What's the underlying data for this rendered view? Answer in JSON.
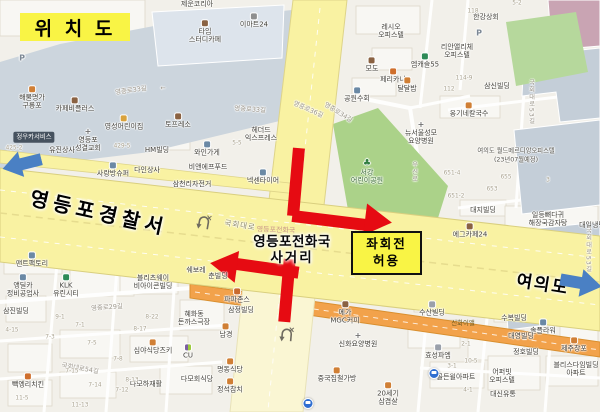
{
  "title": {
    "text": "위 치 도"
  },
  "annotations": {
    "police": "영등포경찰서",
    "yeouido": "여의도",
    "intersection_line1": "영등포전화국",
    "intersection_line2": "사거리",
    "intersection_watermark": "영등포전화국",
    "left_turn_line1": "좌회전",
    "left_turn_line2": "허용"
  },
  "colors": {
    "highlight_yellow": "#f9f445",
    "arrow_red": "#e60b12",
    "arrow_blue": "#4a80c4",
    "road_yellow": "#f9f2a2",
    "road_pale": "#faf6d3",
    "road_orange": "#f2a24b",
    "park_green": "#abd289",
    "site_blue_gray": "#ccd5dd"
  },
  "map_labels": [
    {
      "t": "제운코리아",
      "x": 197,
      "y": 4
    },
    {
      "t": "타임\n스터디카페",
      "x": 205,
      "y": 32,
      "icon": "cafe"
    },
    {
      "t": "이마트24",
      "x": 254,
      "y": 21,
      "icon": "store"
    },
    {
      "t": "해물명가\n구룡포",
      "x": 32,
      "y": 98,
      "icon": "food"
    },
    {
      "t": "카페비플러스",
      "x": 75,
      "y": 105,
      "icon": "cafe"
    },
    {
      "t": "영성어린이집",
      "x": 124,
      "y": 123,
      "icon": "school"
    },
    {
      "t": "영등포\n성결교회",
      "x": 88,
      "y": 140,
      "icon": "church"
    },
    {
      "t": "토프레소",
      "x": 178,
      "y": 121,
      "icon": "cafe"
    },
    {
      "t": "정우카서비스",
      "x": 34,
      "y": 137,
      "cls": "pill"
    },
    {
      "t": "P",
      "x": 22,
      "y": 58,
      "cls": "pmark"
    },
    {
      "t": "레시오\n오피스텔",
      "x": 391,
      "y": 31
    },
    {
      "t": "리안앨리체\n오피스텔",
      "x": 457,
      "y": 51
    },
    {
      "t": "한강상회",
      "x": 486,
      "y": 17
    },
    {
      "t": "P",
      "x": 479,
      "y": 33,
      "cls": "pmark"
    },
    {
      "t": "모도",
      "x": 372,
      "y": 65,
      "icon": "cafe"
    },
    {
      "t": "엠캐슬55",
      "x": 425,
      "y": 61,
      "icon": "bank"
    },
    {
      "t": "페리카나",
      "x": 393,
      "y": 76,
      "icon": "chicken"
    },
    {
      "t": "달달밥",
      "x": 407,
      "y": 85,
      "icon": "food"
    },
    {
      "t": "공원수회",
      "x": 357,
      "y": 95,
      "icon": "shop"
    },
    {
      "t": "옹기네칼국수",
      "x": 469,
      "y": 110,
      "icon": "food"
    },
    {
      "t": "삼신빌딩",
      "x": 497,
      "y": 86
    },
    {
      "t": "뉴서울성모\n요양병원",
      "x": 421,
      "y": 133,
      "icon": "hospital"
    },
    {
      "t": "여의도 월드메르디앙오피스텔",
      "x": 516,
      "y": 151,
      "cls": "small"
    },
    {
      "t": "(23년07월예정)",
      "x": 516,
      "y": 160,
      "cls": "small"
    },
    {
      "t": "서강\n어린이공원",
      "x": 367,
      "y": 172,
      "cls": "park-label",
      "icon": "park"
    },
    {
      "t": "유진상사",
      "x": 62,
      "y": 150
    },
    {
      "t": "HM빌딩",
      "x": 157,
      "y": 150
    },
    {
      "t": "와인가게",
      "x": 207,
      "y": 149,
      "icon": "shop"
    },
    {
      "t": "헤더드\n익스프레스",
      "x": 261,
      "y": 134
    },
    {
      "t": "비앤에프푸드",
      "x": 208,
      "y": 167
    },
    {
      "t": "사랑방슈퍼",
      "x": 113,
      "y": 170,
      "icon": "shop"
    },
    {
      "t": "다인상사",
      "x": 147,
      "y": 170
    },
    {
      "t": "삼천리자전거",
      "x": 192,
      "y": 184
    },
    {
      "t": "넥센타이어",
      "x": 263,
      "y": 177,
      "icon": "shop"
    },
    {
      "t": "대지빌딩",
      "x": 483,
      "y": 210
    },
    {
      "t": "일등뼈다귀\n해장국감자탕",
      "x": 548,
      "y": 219
    },
    {
      "t": "대일냉면",
      "x": 592,
      "y": 225
    },
    {
      "t": "에그카페24",
      "x": 470,
      "y": 231,
      "icon": "cafe"
    },
    {
      "t": "맨트팩토리",
      "x": 32,
      "y": 260,
      "icon": "shop"
    },
    {
      "t": "앵딜카\n정비공업사",
      "x": 23,
      "y": 286,
      "icon": "shop"
    },
    {
      "t": "삼진빌딩",
      "x": 16,
      "y": 311
    },
    {
      "t": "KLK\n유린시티",
      "x": 66,
      "y": 286,
      "icon": "bank"
    },
    {
      "t": "블리츠웨이\n비아이콘빌딩",
      "x": 153,
      "y": 282
    },
    {
      "t": "쉐보레",
      "x": 196,
      "y": 270
    },
    {
      "t": "춘빌딩",
      "x": 218,
      "y": 276
    },
    {
      "t": "혜화동\n돈까스극장",
      "x": 194,
      "y": 318
    },
    {
      "t": "심야식당츠키",
      "x": 153,
      "y": 347,
      "icon": "food"
    },
    {
      "t": "CU",
      "x": 188,
      "y": 352,
      "icon": "cu"
    },
    {
      "t": "다모하재활",
      "x": 146,
      "y": 384
    },
    {
      "t": "다모회식당",
      "x": 197,
      "y": 379
    },
    {
      "t": "빽엥리치킨",
      "x": 28,
      "y": 381,
      "icon": "chicken"
    },
    {
      "t": "명동식당",
      "x": 230,
      "y": 366,
      "icon": "food"
    },
    {
      "t": "정석참치",
      "x": 230,
      "y": 386,
      "icon": "food"
    },
    {
      "t": "남경",
      "x": 226,
      "y": 331,
      "icon": "food"
    },
    {
      "t": "파파존스",
      "x": 237,
      "y": 296,
      "icon": "pizza"
    },
    {
      "t": "삼정빌딩",
      "x": 241,
      "y": 310
    },
    {
      "t": "메가\nMGC커피",
      "x": 345,
      "y": 313,
      "icon": "cafe"
    },
    {
      "t": "신화요양병원",
      "x": 358,
      "y": 340,
      "icon": "hospital"
    },
    {
      "t": "중국집철가방",
      "x": 337,
      "y": 375,
      "icon": "food"
    },
    {
      "t": "20세기\n삼겹살",
      "x": 388,
      "y": 394,
      "icon": "food"
    },
    {
      "t": "수산빌딩",
      "x": 432,
      "y": 309,
      "icon": "bldg"
    },
    {
      "t": "수복빌딩",
      "x": 514,
      "y": 318
    },
    {
      "t": "솔플라워",
      "x": 543,
      "y": 327,
      "icon": "shop"
    },
    {
      "t": "신화이앨",
      "x": 463,
      "y": 324,
      "cls": "onroad"
    },
    {
      "t": "대영빌딩",
      "x": 521,
      "y": 336
    },
    {
      "t": "제주창포",
      "x": 574,
      "y": 345,
      "icon": "food"
    },
    {
      "t": "정호빌딩",
      "x": 526,
      "y": 352
    },
    {
      "t": "블리스다임빌딩\n아파트",
      "x": 576,
      "y": 369
    },
    {
      "t": "효성파엠",
      "x": 438,
      "y": 352,
      "icon": "bldg"
    },
    {
      "t": "골든윌아파트",
      "x": 456,
      "y": 377
    },
    {
      "t": "어퍼빗\n오피스텔",
      "x": 502,
      "y": 376
    },
    {
      "t": "대신유통",
      "x": 503,
      "y": 394
    },
    {
      "t": "영중로33길",
      "x": 131,
      "y": 91,
      "rot": -8,
      "cls": "street"
    },
    {
      "t": "←",
      "x": 163,
      "y": 89,
      "cls": "street"
    },
    {
      "t": "영중로33길",
      "x": 250,
      "y": 110,
      "rot": 4,
      "cls": "street"
    },
    {
      "t": "영중로36길",
      "x": 308,
      "y": 110,
      "rot": 24,
      "cls": "street"
    },
    {
      "t": "영중로34길",
      "x": 338,
      "y": 113,
      "rot": 32,
      "cls": "street"
    },
    {
      "t": "국회대로",
      "x": 240,
      "y": 226,
      "rot": 9,
      "cls": "roadname"
    },
    {
      "t": "국회대로53길",
      "x": 531,
      "y": 102,
      "cls": "vstreet"
    },
    {
      "t": "국회대로53길",
      "x": 588,
      "y": 250,
      "cls": "vstreet"
    },
    {
      "t": "우신로",
      "x": 414,
      "y": 172,
      "cls": "vstreet"
    },
    {
      "t": "국회대로54길",
      "x": 80,
      "y": 369,
      "rot": 10,
      "cls": "street"
    },
    {
      "t": "영중로29길",
      "x": 107,
      "y": 308,
      "rot": -4,
      "cls": "street"
    },
    {
      "t": "118",
      "x": 473,
      "y": 12,
      "cls": "lot"
    },
    {
      "t": "114-9",
      "x": 464,
      "y": 79,
      "cls": "lot"
    },
    {
      "t": "112",
      "x": 449,
      "y": 90,
      "cls": "lot"
    },
    {
      "t": "5-2",
      "x": 517,
      "y": 4,
      "cls": "lot"
    },
    {
      "t": "429-5",
      "x": 122,
      "y": 147,
      "cls": "lot"
    },
    {
      "t": "425-2",
      "x": 14,
      "y": 149,
      "cls": "lot"
    },
    {
      "t": "5-5",
      "x": 237,
      "y": 144,
      "cls": "lot"
    },
    {
      "t": "651-4",
      "x": 452,
      "y": 174,
      "cls": "lot"
    },
    {
      "t": "651-2",
      "x": 456,
      "y": 197,
      "cls": "lot"
    },
    {
      "t": "655",
      "x": 506,
      "y": 178,
      "cls": "lot"
    },
    {
      "t": "653",
      "x": 492,
      "y": 190,
      "cls": "lot"
    },
    {
      "t": "3",
      "x": 548,
      "y": 181,
      "cls": "lot"
    },
    {
      "t": "9-1",
      "x": 60,
      "y": 318,
      "cls": "lot"
    },
    {
      "t": "7-1",
      "x": 80,
      "y": 326,
      "cls": "lot"
    },
    {
      "t": "7-3",
      "x": 50,
      "y": 338,
      "cls": "lot"
    },
    {
      "t": "7-5",
      "x": 92,
      "y": 344,
      "cls": "lot"
    },
    {
      "t": "7-8",
      "x": 118,
      "y": 360,
      "cls": "lot"
    },
    {
      "t": "7-15",
      "x": 72,
      "y": 372,
      "cls": "lot"
    },
    {
      "t": "7-14",
      "x": 95,
      "y": 386,
      "cls": "lot"
    },
    {
      "t": "7-12",
      "x": 122,
      "y": 391,
      "cls": "lot"
    },
    {
      "t": "8-13",
      "x": 132,
      "y": 381,
      "cls": "lot"
    },
    {
      "t": "8-17",
      "x": 140,
      "y": 330,
      "cls": "lot"
    },
    {
      "t": "8-22",
      "x": 152,
      "y": 318,
      "cls": "lot"
    },
    {
      "t": "11-5",
      "x": 22,
      "y": 399,
      "cls": "lot"
    },
    {
      "t": "11-13",
      "x": 80,
      "y": 406,
      "cls": "lot"
    },
    {
      "t": "4-15",
      "x": 12,
      "y": 331,
      "cls": "lot"
    },
    {
      "t": "2-1",
      "x": 466,
      "y": 345,
      "cls": "lot"
    },
    {
      "t": "4-1",
      "x": 468,
      "y": 391,
      "cls": "lot"
    },
    {
      "t": "10-5",
      "x": 471,
      "y": 362,
      "cls": "lot"
    },
    {
      "t": "3-1",
      "x": 452,
      "y": 367,
      "cls": "lot"
    },
    {
      "t": "",
      "x": 434,
      "y": 374,
      "icon": "bus",
      "cls": "icononly"
    },
    {
      "t": "",
      "x": 308,
      "y": 404,
      "icon": "bus",
      "cls": "icononly"
    }
  ]
}
